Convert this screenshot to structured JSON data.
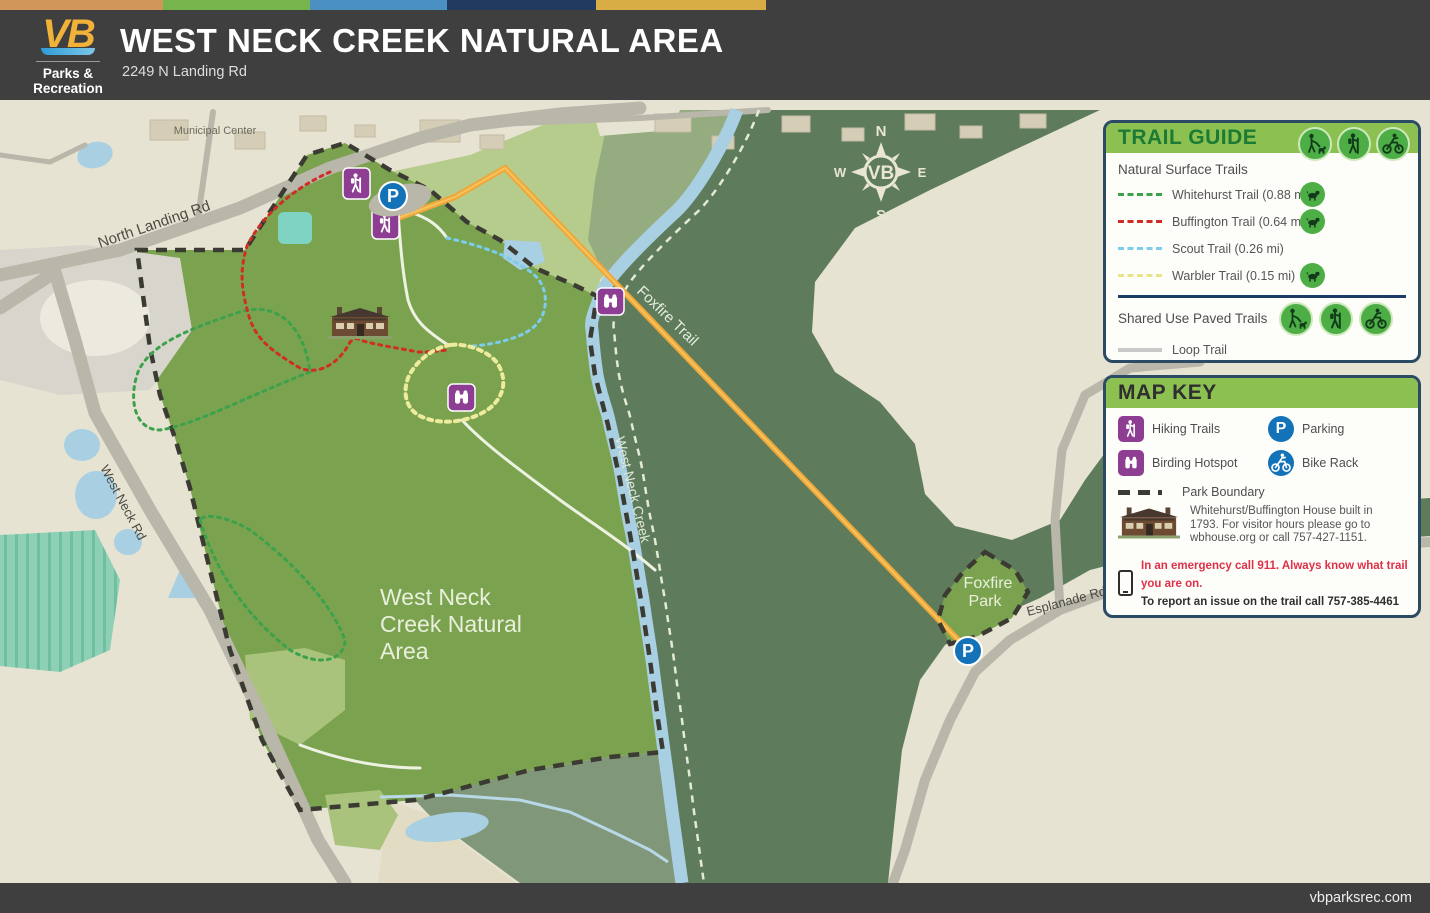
{
  "header": {
    "title": "WEST NECK CREEK NATURAL AREA",
    "subtitle": "2249 N Landing Rd",
    "logo": {
      "vb": "VB",
      "org_line1": "Parks &",
      "org_line2": "Recreation"
    },
    "stripe_colors": [
      "#d1975a",
      "#76b54b",
      "#4a90c2",
      "#223a5e",
      "#d9ad45"
    ]
  },
  "footer": {
    "website": "vbparksrec.com"
  },
  "trail_guide": {
    "title": "TRAIL GUIDE",
    "activity_icons": [
      "dog-walking",
      "hiking",
      "biking"
    ],
    "natural": {
      "heading": "Natural Surface Trails",
      "trails": [
        {
          "label": "Whitehurst Trail (0.88 mi)",
          "color": "#3da14c",
          "style": "dashed",
          "dog_friendly": true
        },
        {
          "label": "Buffington Trail (0.64 mi)",
          "color": "#cf2e24",
          "style": "dashed",
          "dog_friendly": true
        },
        {
          "label": "Scout Trail (0.26 mi)",
          "color": "#7ccdec",
          "style": "dashed",
          "dog_friendly": false
        },
        {
          "label": "Warbler Trail (0.15 mi)",
          "color": "#e9e48a",
          "style": "dashed",
          "dog_friendly": true
        }
      ]
    },
    "paved": {
      "heading": "Shared Use Paved Trails",
      "trails": [
        {
          "label": "Loop Trail",
          "color": "#c9c9c9",
          "style": "solid"
        },
        {
          "label": "Foxfire Trail (1 mi)",
          "color": "#f0a73a",
          "style": "solid"
        }
      ]
    }
  },
  "map_key": {
    "title": "MAP KEY",
    "items": [
      {
        "icon": "hiking-trails-icon",
        "label": "Hiking Trails"
      },
      {
        "icon": "parking-icon",
        "label": "Parking"
      },
      {
        "icon": "birding-hotspot-icon",
        "label": "Birding Hotspot"
      },
      {
        "icon": "bike-rack-icon",
        "label": "Bike Rack"
      },
      {
        "icon": "park-boundary",
        "label": "Park Boundary"
      }
    ],
    "house_note": "Whitehurst/Buffington House built in 1793. For visitor hours please go to wbhouse.org or call 757-427-1151.",
    "emergency_red": "In an emergency call 911. Always know what trail you are on.",
    "emergency_black": "To report an issue on the trail call 757-385-4461"
  },
  "map": {
    "labels": {
      "municipal_center": "Municipal Center",
      "north_landing_rd": "North Landing Rd",
      "west_neck_rd": "West Neck Rd",
      "west_neck_creek": "West Neck Creek",
      "foxfire_trail": "Foxfire Trail",
      "park_name_line1": "West Neck",
      "park_name_line2": "Creek Natural",
      "park_name_line3": "Area",
      "foxfire_park_line1": "Foxfire",
      "foxfire_park_line2": "Park",
      "esplanade_rd": "Esplanade Rd"
    },
    "compass": {
      "n": "N",
      "s": "S",
      "e": "E",
      "w": "W",
      "center": "VB"
    },
    "parking_letter": "P",
    "colors": {
      "park_green": "#7ba34f",
      "forest_green": "#5e7c5b",
      "light_green": "#b6cc8d",
      "wetland_green": "#81977a",
      "water_blue": "#a9cfe2",
      "teal_pond": "#7fd3c3",
      "beige": "#e7e3d2",
      "road_gray": "#b9b6aa",
      "boundary_dark": "#3b3b33",
      "purple_icon": "#8d3d92",
      "parking_blue": "#1372b8",
      "foxfire_orange": "#f0a73a"
    }
  }
}
